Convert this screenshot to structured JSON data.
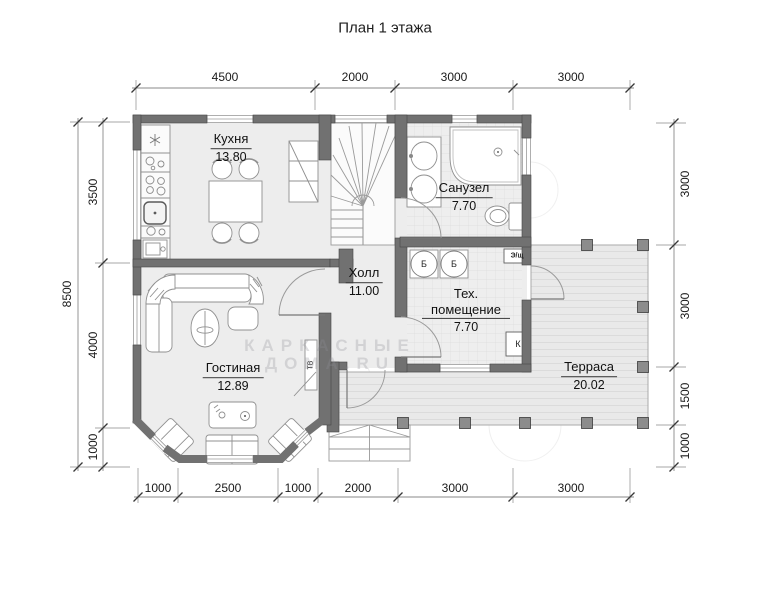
{
  "title": "План 1 этажа",
  "rooms": {
    "kitchen": {
      "name": "Кухня",
      "area": "13.80"
    },
    "hall": {
      "name": "Холл",
      "area": "11.00"
    },
    "bathroom": {
      "name": "Санузел",
      "area": "7.70"
    },
    "tech": {
      "name": "Тех. помещение",
      "area": "7.70"
    },
    "living": {
      "name": "Гостиная",
      "area": "12.89"
    },
    "terrace": {
      "name": "Терраса",
      "area": "20.02"
    }
  },
  "equipment": {
    "boiler": "Б",
    "electrical_panel": "Э/щ",
    "boiler_unit": "К",
    "tv": "ТВ"
  },
  "dimensions": {
    "top": [
      "4500",
      "2000",
      "3000",
      "3000"
    ],
    "bottom": [
      "1000",
      "2500",
      "1000",
      "2000",
      "3000",
      "3000"
    ],
    "left_outer": [
      "8500"
    ],
    "left_inner": [
      "3500",
      "4000",
      "1000"
    ],
    "right": [
      "3000",
      "3000",
      "1500",
      "1000"
    ]
  },
  "watermark": {
    "line1": "КАРКАСНЫЕ",
    "line2": "ДОМА.RU"
  },
  "colors": {
    "wall": "#717171",
    "floor": "#ededed",
    "tile_floor": "#eeeeee",
    "terrace_floor": "#e9e9e9",
    "furniture_stroke": "#909090",
    "dimension_line": "#8a8a8a",
    "text": "#1a1a1a"
  }
}
